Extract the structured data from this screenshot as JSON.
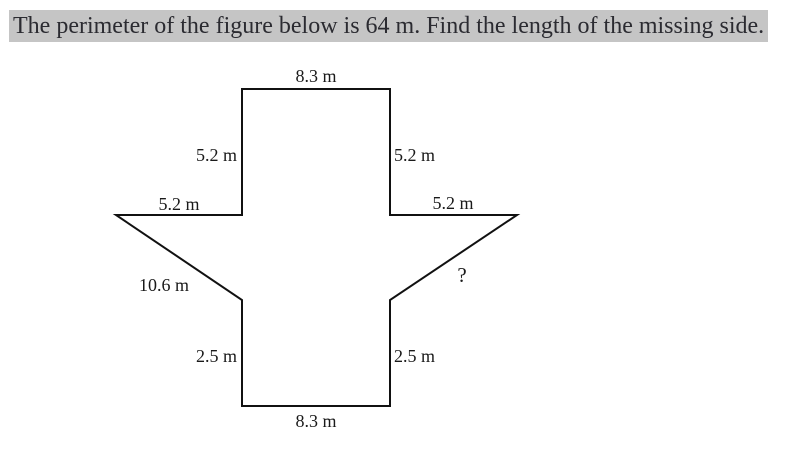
{
  "question": {
    "text": "The perimeter of the figure below is 64 m. Find the length of the missing side."
  },
  "figure": {
    "type": "labeled-polygon",
    "labels": {
      "top": "8.3 m",
      "upper_left_vertical": "5.2 m",
      "upper_right_vertical": "5.2 m",
      "left_horizontal": "5.2 m",
      "right_horizontal": "5.2 m",
      "left_diagonal": "10.6 m",
      "missing_side": "?",
      "lower_left_vertical": "2.5 m",
      "lower_right_vertical": "2.5 m",
      "bottom": "8.3 m"
    }
  },
  "colors": {
    "page_background": "#ffffff",
    "question_highlight": "#c5c5c5",
    "question_text": "#2b2b31",
    "figure_stroke": "#111111",
    "label_text": "#1a1a1a"
  }
}
